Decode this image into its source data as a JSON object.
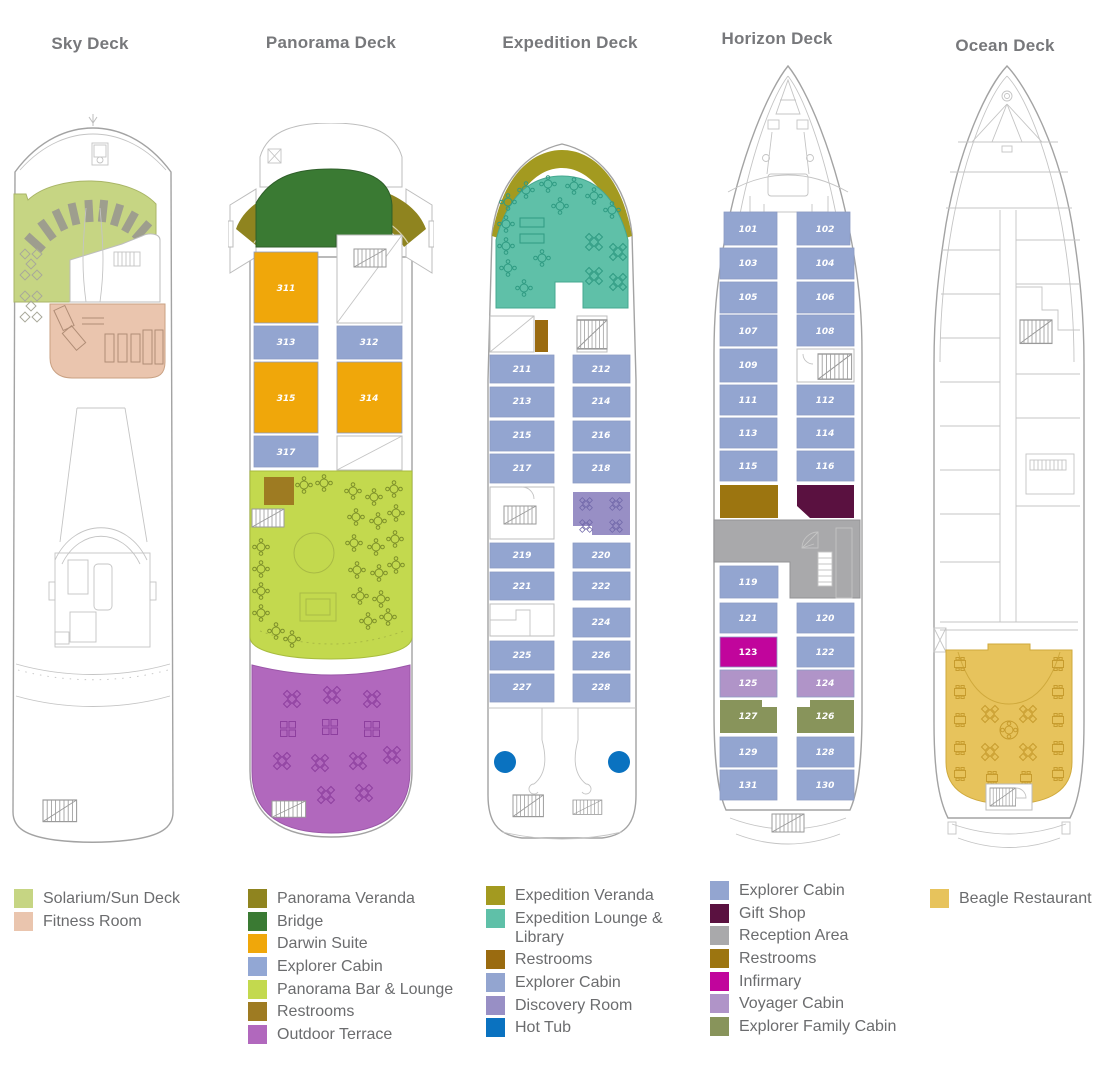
{
  "title_color": "#77787b",
  "decks": [
    {
      "title": "Sky Deck",
      "legend": [
        {
          "label": "Solarium/Sun Deck",
          "color": "#c6d583"
        },
        {
          "label": "Fitness Room",
          "color": "#eac5ae"
        }
      ]
    },
    {
      "title": "Panorama Deck",
      "legend": [
        {
          "label": "Panorama Veranda",
          "color": "#8f841f"
        },
        {
          "label": "Bridge",
          "color": "#3a7a33"
        },
        {
          "label": "Darwin Suite",
          "color": "#f0a70a"
        },
        {
          "label": "Explorer Cabin",
          "color": "#92a7d4"
        },
        {
          "label": "Panorama Bar & Lounge",
          "color": "#c3d94e"
        },
        {
          "label": "Restrooms",
          "color": "#9e7b22"
        },
        {
          "label": "Outdoor Terrace",
          "color": "#b168bd"
        }
      ],
      "cabins": {
        "left": [
          "311",
          "313",
          "315",
          "317"
        ],
        "right": [
          "312",
          "314"
        ]
      }
    },
    {
      "title": "Expedition Deck",
      "legend": [
        {
          "label": "Expedition Veranda",
          "color": "#a39a20"
        },
        {
          "label": "Expedition Lounge & Library",
          "color": "#5fc0a8"
        },
        {
          "label": "Restrooms",
          "color": "#9a6b10"
        },
        {
          "label": "Explorer Cabin",
          "color": "#93a5d0"
        },
        {
          "label": "Discovery Room",
          "color": "#988fc5"
        },
        {
          "label": "Hot Tub",
          "color": "#0a72c0"
        }
      ],
      "cabins": {
        "left": [
          "211",
          "213",
          "215",
          "217",
          "219",
          "221",
          "225",
          "227"
        ],
        "right": [
          "212",
          "214",
          "216",
          "218",
          "220",
          "222",
          "224",
          "226",
          "228"
        ]
      }
    },
    {
      "title": "Horizon Deck",
      "legend": [
        {
          "label": "Explorer Cabin",
          "color": "#93a5d0"
        },
        {
          "label": "Gift Shop",
          "color": "#5a1140"
        },
        {
          "label": "Reception Area",
          "color": "#a9a9ab"
        },
        {
          "label": "Restrooms",
          "color": "#9c7510"
        },
        {
          "label": "Infirmary",
          "color": "#c1059c"
        },
        {
          "label": "Voyager Cabin",
          "color": "#b094c8"
        },
        {
          "label": "Explorer Family Cabin",
          "color": "#88945b"
        }
      ],
      "cabins": {
        "left": [
          "101",
          "103",
          "105",
          "107",
          "109",
          "111",
          "113",
          "115",
          "119",
          "121",
          "123",
          "125",
          "127",
          "129",
          "131"
        ],
        "right": [
          "102",
          "104",
          "106",
          "108",
          "112",
          "114",
          "116",
          "120",
          "122",
          "124",
          "126",
          "128",
          "130"
        ]
      }
    },
    {
      "title": "Ocean Deck",
      "legend": [
        {
          "label": "Beagle Restaurant",
          "color": "#e7c35c"
        }
      ]
    }
  ]
}
